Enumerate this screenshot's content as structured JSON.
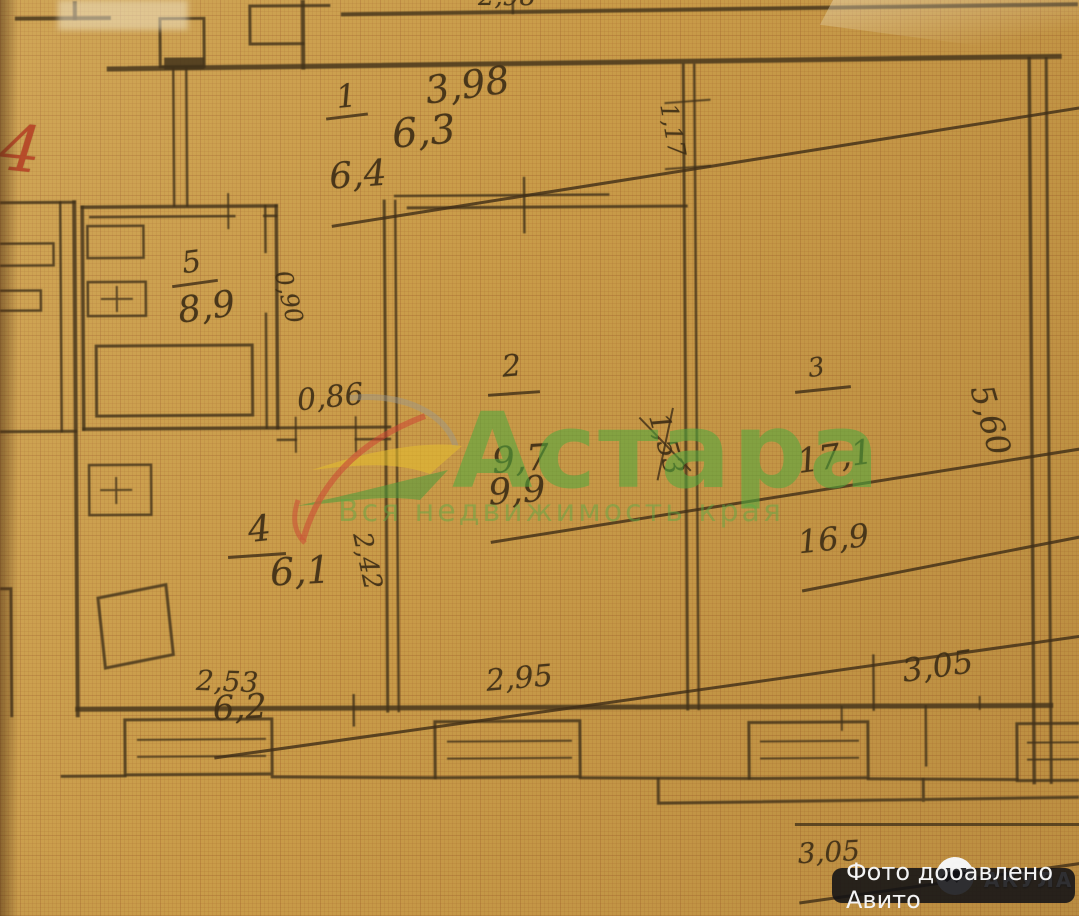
{
  "plan": {
    "rooms": [
      {
        "number": "1",
        "area_old": "6,4",
        "area_new": "6,3"
      },
      {
        "number": "2",
        "area_old": "9,9",
        "area_new": "9,7"
      },
      {
        "number": "3",
        "area_old": "16,9",
        "area_new": "17,1"
      },
      {
        "number": "4",
        "area_old": "6,2",
        "area_new": "6,1"
      },
      {
        "number": "5",
        "area": "8,9"
      }
    ],
    "dims": {
      "hall_width": "3,98",
      "top_partial": "2,98",
      "wall_seg": "1,17",
      "door_room5": "0,90",
      "door_room4": "0,86",
      "room3_height": "5,60",
      "room4_height": "2,42",
      "room2_crossed": "1,53",
      "bottom_room4": "2,53",
      "bottom_room2": "2,95",
      "bottom_room3_old": "3,05",
      "bottom_room3_new": "3,05"
    },
    "red_mark": "4"
  },
  "watermark": {
    "brand": "Астара",
    "tagline": "Вся недвижимость края"
  },
  "badge": {
    "photo_note": "Фото добавлено Авито",
    "agency": "АКУЛА"
  }
}
